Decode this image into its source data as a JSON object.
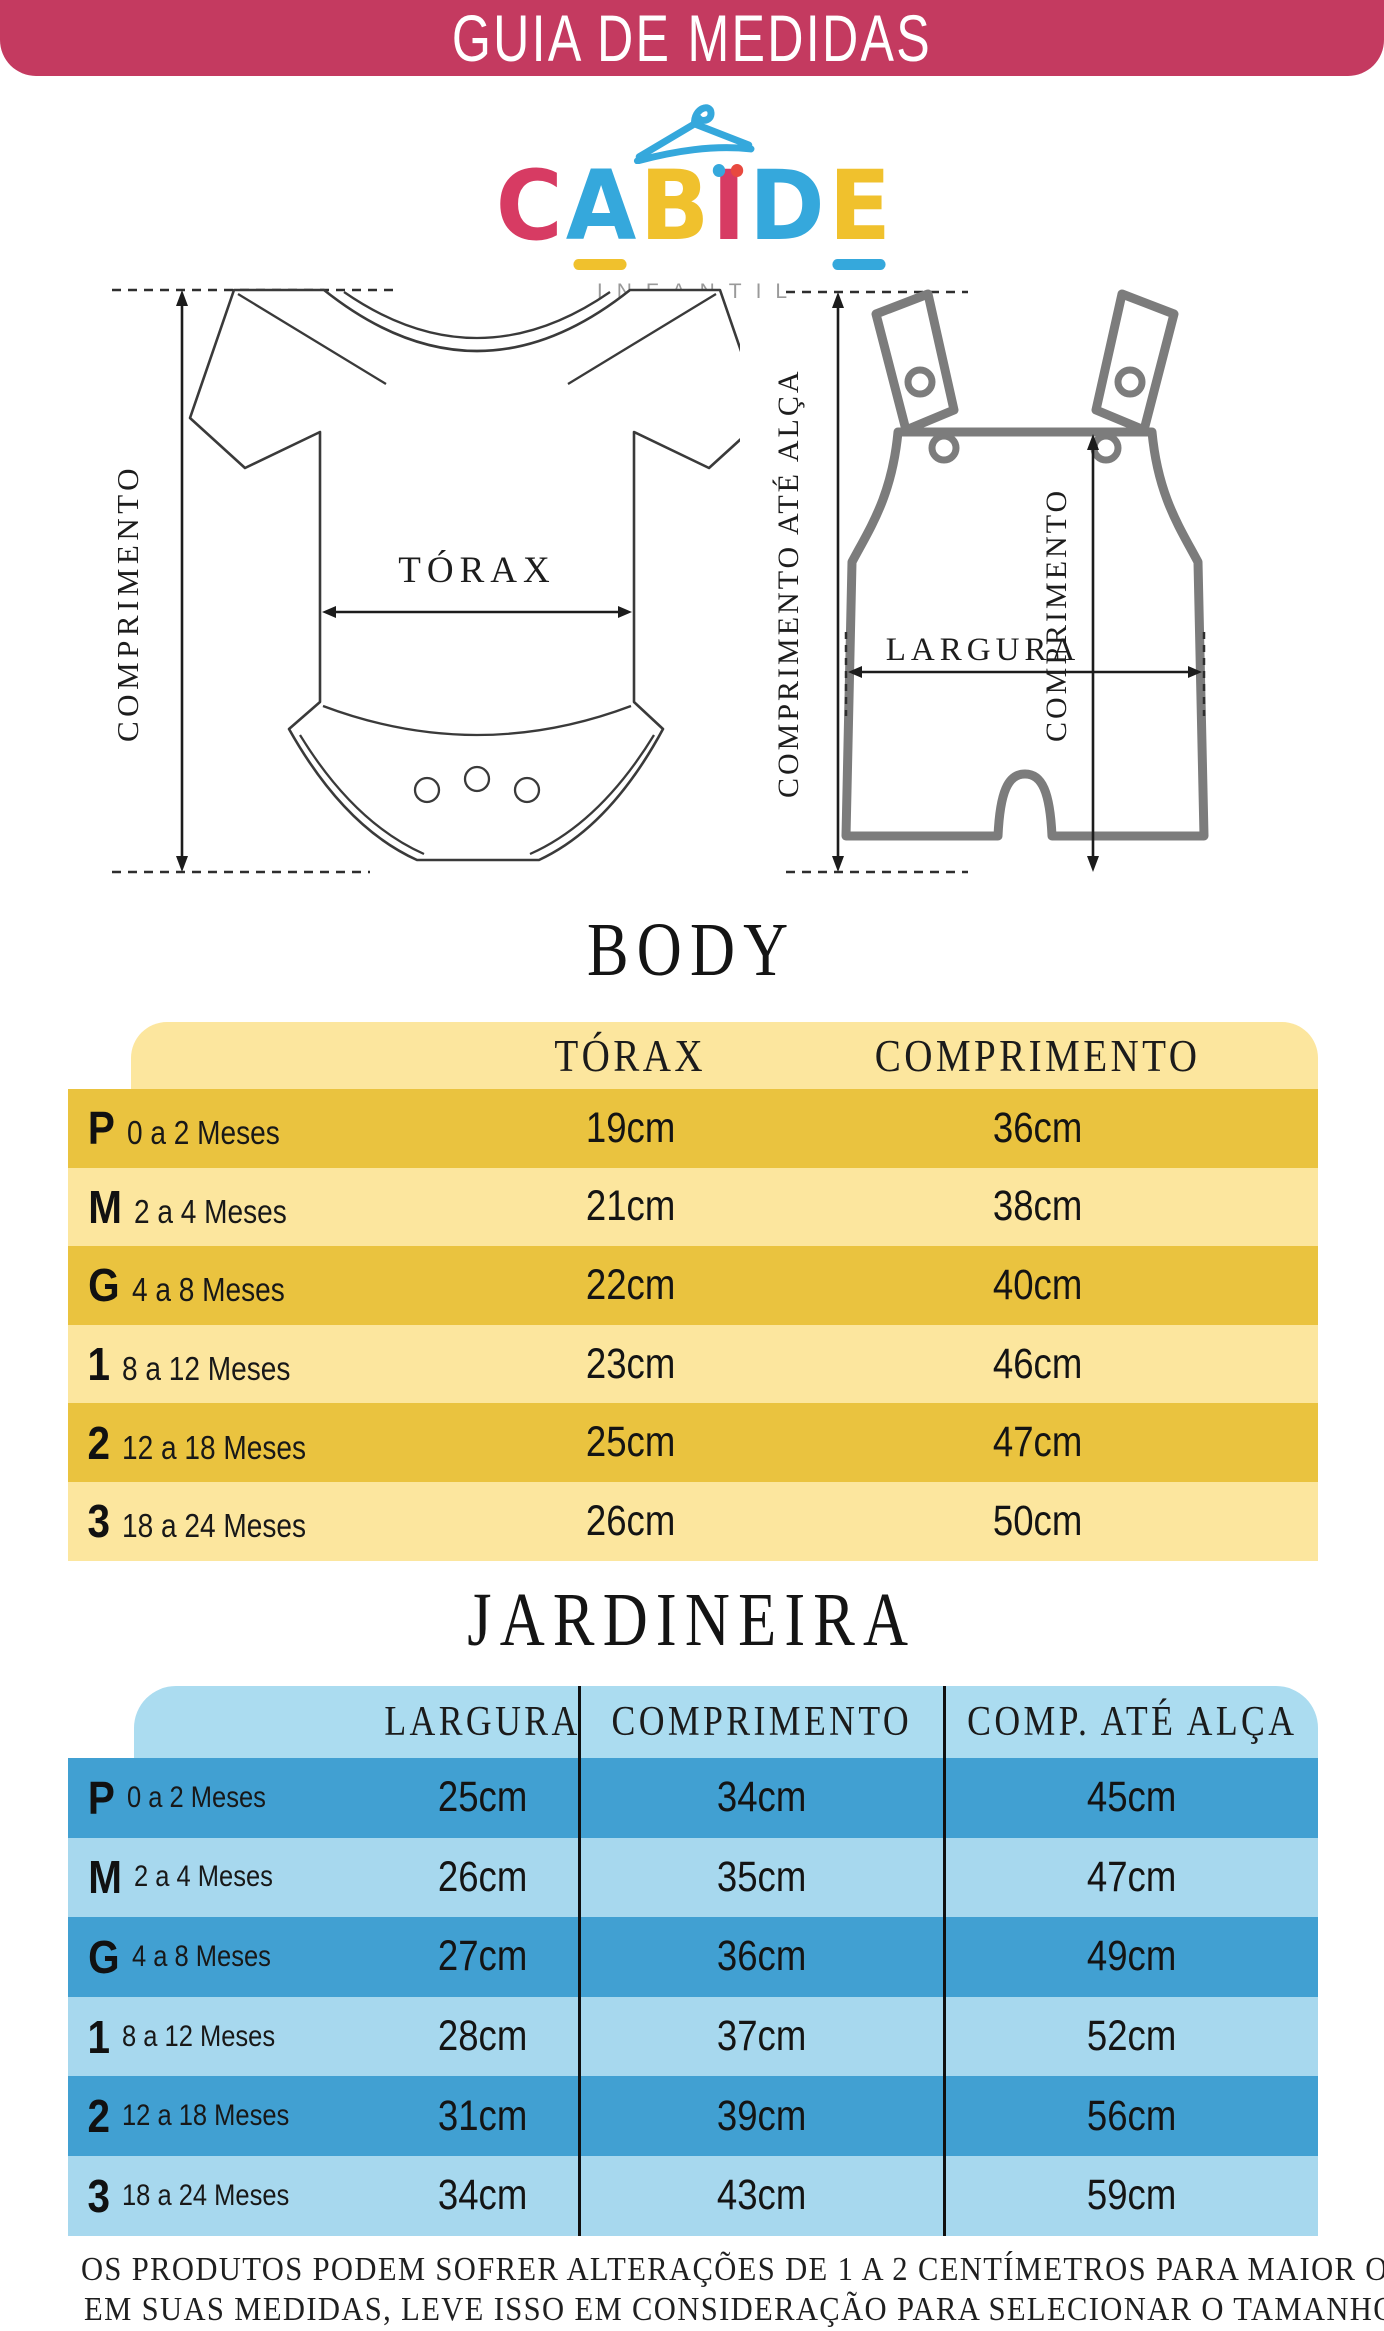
{
  "header": {
    "title": "GUIA DE MEDIDAS",
    "bg_color": "#C43A60"
  },
  "logo": {
    "letters": [
      {
        "char": "C",
        "color": "#D73B63"
      },
      {
        "char": "A",
        "color": "#35A8DC",
        "underline": "#F0C12D"
      },
      {
        "char": "B",
        "color": "#F0C12D"
      },
      {
        "char": "I",
        "color": "#D73B63",
        "dots": [
          "#35A8DC",
          "#E8493F"
        ]
      },
      {
        "char": "D",
        "color": "#35A8DC"
      },
      {
        "char": "E",
        "color": "#F0C12D",
        "underline": "#35A8DC"
      }
    ],
    "subtitle": "INFANTIL",
    "hanger_color": "#35A8DC"
  },
  "diagrams": {
    "body": {
      "length_label": "COMPRIMENTO",
      "chest_label": "TÓRAX"
    },
    "jardineira": {
      "strap_length_label": "COMPRIMENTO ATÉ ALÇA",
      "length_label": "COMPRIMENTO",
      "width_label": "LARGURA"
    }
  },
  "body_table": {
    "title": "BODY",
    "columns": [
      "TÓRAX",
      "COMPRIMENTO"
    ],
    "colors": {
      "row_dark": "#EAC33F",
      "row_light": "#FCE69E",
      "header_bg": "#FCE69E"
    },
    "rows": [
      {
        "size": "P",
        "age": "0 a 2 Meses",
        "torax": "19cm",
        "comprimento": "36cm"
      },
      {
        "size": "M",
        "age": "2 a 4 Meses",
        "torax": "21cm",
        "comprimento": "38cm"
      },
      {
        "size": "G",
        "age": "4 a 8 Meses",
        "torax": "22cm",
        "comprimento": "40cm"
      },
      {
        "size": "1",
        "age": "8 a 12 Meses",
        "torax": "23cm",
        "comprimento": "46cm"
      },
      {
        "size": "2",
        "age": "12 a 18 Meses",
        "torax": "25cm",
        "comprimento": "47cm"
      },
      {
        "size": "3",
        "age": "18 a 24 Meses",
        "torax": "26cm",
        "comprimento": "50cm"
      }
    ]
  },
  "jardineira_table": {
    "title": "JARDINEIRA",
    "columns": [
      "LARGURA",
      "COMPRIMENTO",
      "COMP. ATÉ ALÇA"
    ],
    "colors": {
      "row_dark": "#41A0D2",
      "row_light": "#A7D8EE",
      "header_bg": "#ABDCF0"
    },
    "rows": [
      {
        "size": "P",
        "age": "0 a 2 Meses",
        "largura": "25cm",
        "comprimento": "34cm",
        "comp_ate_alca": "45cm"
      },
      {
        "size": "M",
        "age": "2 a 4 Meses",
        "largura": "26cm",
        "comprimento": "35cm",
        "comp_ate_alca": "47cm"
      },
      {
        "size": "G",
        "age": "4 a 8 Meses",
        "largura": "27cm",
        "comprimento": "36cm",
        "comp_ate_alca": "49cm"
      },
      {
        "size": "1",
        "age": "8 a 12 Meses",
        "largura": "28cm",
        "comprimento": "37cm",
        "comp_ate_alca": "52cm"
      },
      {
        "size": "2",
        "age": "12 a 18 Meses",
        "largura": "31cm",
        "comprimento": "39cm",
        "comp_ate_alca": "56cm"
      },
      {
        "size": "3",
        "age": "18 a 24 Meses",
        "largura": "34cm",
        "comprimento": "43cm",
        "comp_ate_alca": "59cm"
      }
    ]
  },
  "footer": {
    "line1": "OS PRODUTOS PODEM SOFRER ALTERAÇÕES DE 1 A 2 CENTÍMETROS PARA MAIOR OU MENOR",
    "line2": "EM SUAS MEDIDAS, LEVE ISSO EM CONSIDERAÇÃO PARA SELECIONAR O TAMANHO ADEQUADO."
  }
}
